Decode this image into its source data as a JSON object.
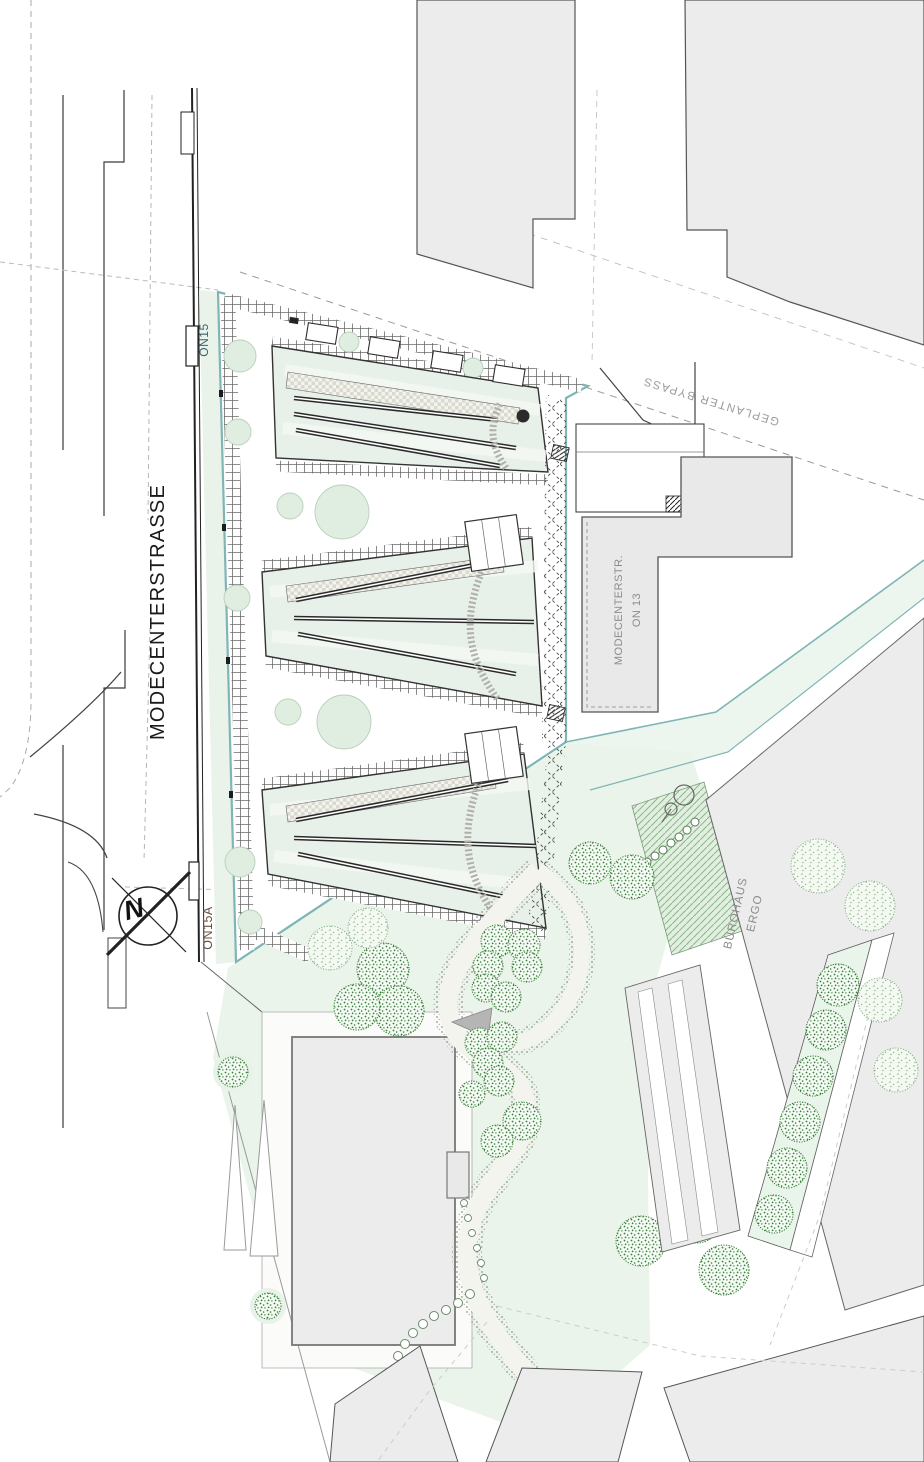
{
  "meta": {
    "type": "architectural-site-plan",
    "orientation_marker": "north-arrow"
  },
  "labels": {
    "street": "MODECENTERSTRASSE",
    "stop_north": "ON15",
    "stop_south": "ON15A",
    "bypass": "GEPLANTER BYPASS",
    "on13_line1": "MODECENTERSTR.",
    "on13_line2": "ON 13",
    "ergo_line1": "BÜROHAUS",
    "ergo_line2": "ERGO",
    "north_letter": "N"
  },
  "colors": {
    "site_boundary_teal": "#7fb5b5",
    "roof_green": "#e8f1e9",
    "park_green": "#eaf4ea",
    "building_gray": "#ececec",
    "tree_dark_green": "#3a7d3a",
    "tree_light_green": "#86b286",
    "line_dark": "#2b2b2b",
    "label_gray": "#8c8c8c",
    "stop_north_color": "#3a6472",
    "stop_south_color": "#6b4f3f"
  }
}
